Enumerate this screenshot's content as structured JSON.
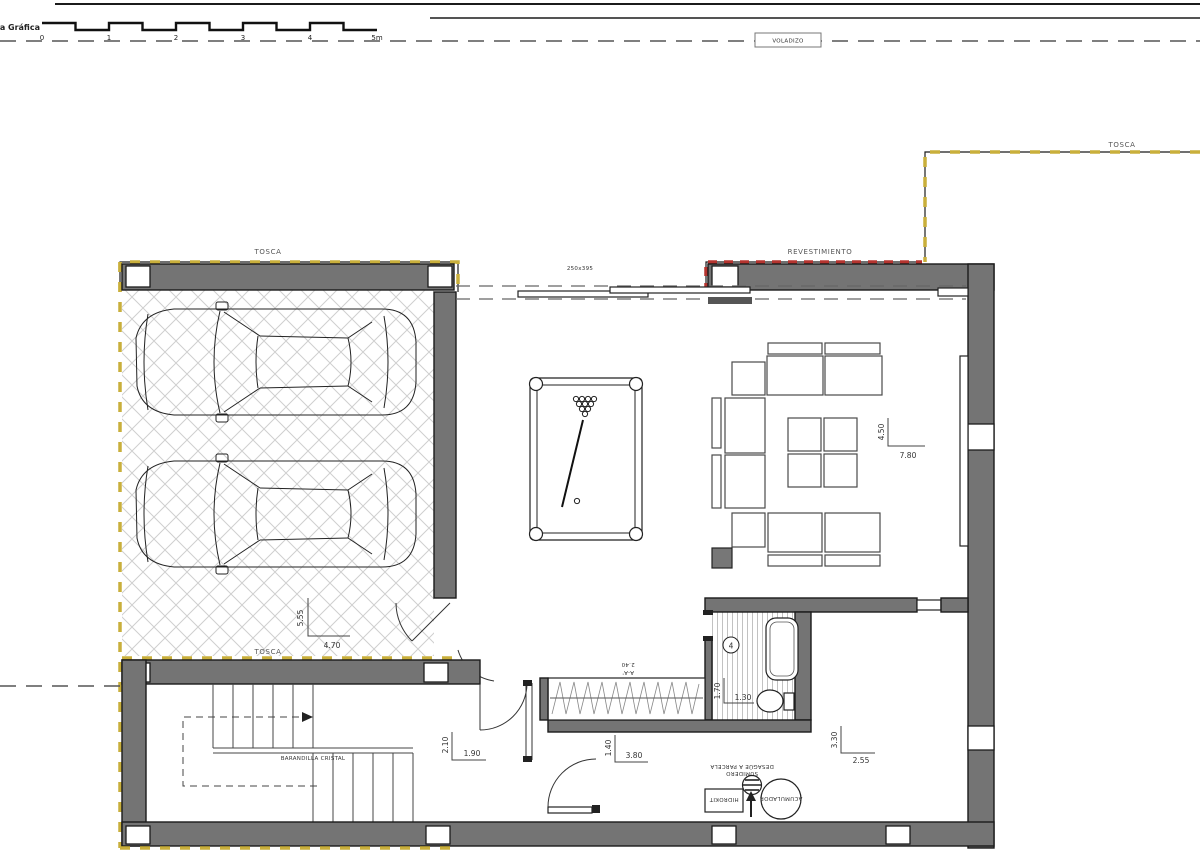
{
  "colors": {
    "wall_gray": "#747474",
    "outline_black": "#1b1b1b",
    "tosca_yellow": "#c9af3b",
    "revestimiento_red": "#b5342f",
    "hatch_gray": "#cfcfcf",
    "dim_text": "#333333"
  },
  "scale_bar": {
    "title": "Escala Gráfica",
    "ticks": [
      "0",
      "1",
      "2",
      "3",
      "4",
      "5m"
    ]
  },
  "labels": {
    "voladizo": "VOLADIZO",
    "tosca_site": "TOSCA",
    "tosca_garage_top": "TOSCA",
    "tosca_garage_bottom": "TOSCA",
    "revestimiento": "REVESTIMIENTO",
    "window_size": "250x395",
    "barandilla": "BARANDILLA CRISTAL",
    "section_label": "A-A'",
    "section_value": "2.40",
    "sumidero_line1": "SUMIDERO",
    "sumidero_line2": "DESAGÜE A PARCELA",
    "acumulador": "ACUMULADOR",
    "hidrokit": "HIDROKIT",
    "bathroom_number": "4"
  },
  "dimensions": {
    "garage_depth": "5.55",
    "garage_width": "4.70",
    "living_depth": "4.50",
    "living_width": "7.80",
    "landing_depth": "2.10",
    "landing_width": "1.90",
    "corridor_depth": "1.40",
    "corridor_width": "3.80",
    "bathroom_depth": "1.70",
    "bathroom_width": "1.30",
    "store_depth": "3.30",
    "store_width": "2.55"
  }
}
